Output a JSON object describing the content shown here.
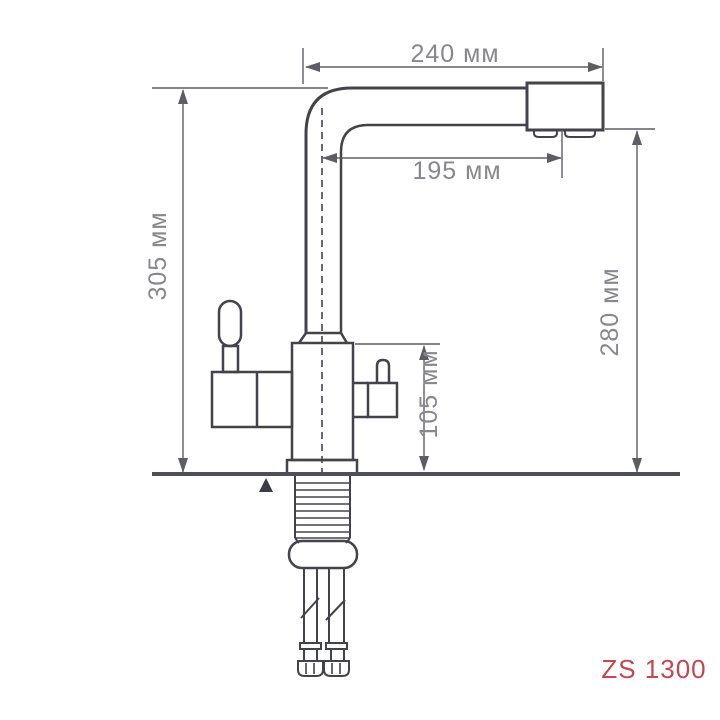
{
  "drawing": {
    "model": "ZS 1300",
    "units": "мм",
    "dimensions": {
      "top_width_label": "240 мм",
      "spout_reach_label": "195 мм",
      "total_height_label": "305 мм",
      "spout_height_label": "280 мм",
      "body_height_label": "105 мм"
    },
    "dimension_values": {
      "top_width_mm": 240,
      "spout_reach_mm": 195,
      "total_height_mm": 305,
      "spout_height_mm": 280,
      "body_height_mm": 105
    },
    "colors": {
      "outline": "#43434b",
      "dimension_lines": "#5d5d65",
      "dimension_text": "#87878d",
      "surface_line": "#4f4f57",
      "model_text": "#c5464f",
      "background": "#ffffff"
    }
  }
}
